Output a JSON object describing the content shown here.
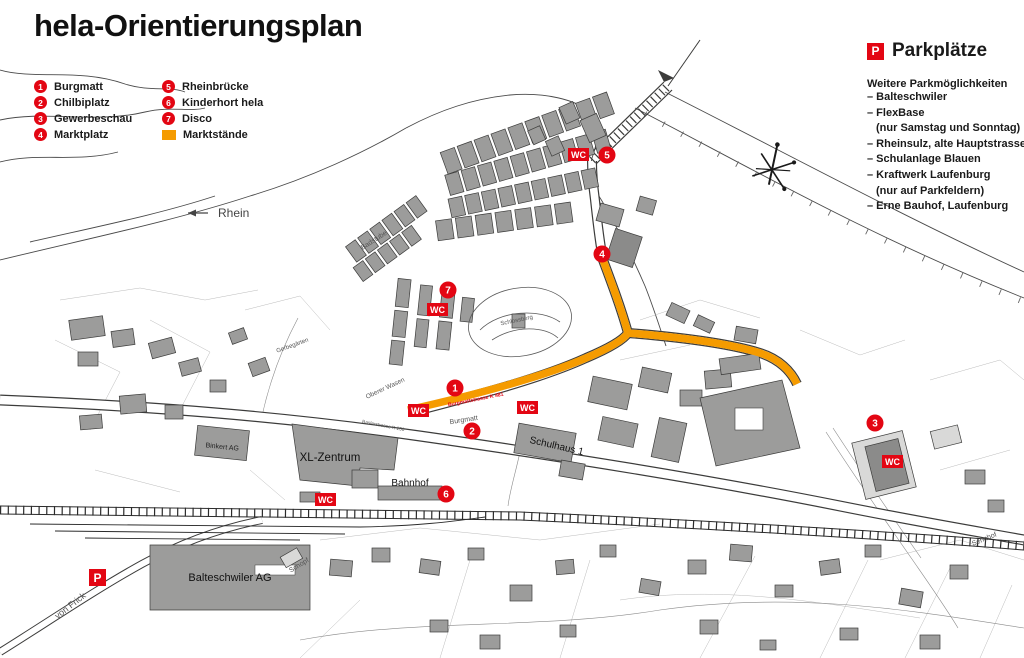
{
  "title": "hela-Orientierungsplan",
  "legend": {
    "items": [
      {
        "num": "1",
        "label": "Burgmatt"
      },
      {
        "num": "2",
        "label": "Chilbiplatz"
      },
      {
        "num": "3",
        "label": "Gewerbeschau"
      },
      {
        "num": "4",
        "label": "Marktplatz"
      },
      {
        "num": "5",
        "label": "Rheinbrücke"
      },
      {
        "num": "6",
        "label": "Kinderhort hela"
      },
      {
        "num": "7",
        "label": "Disco"
      }
    ],
    "swatch_label": "Marktstände"
  },
  "parking": {
    "badge": "P",
    "title": "Parkplätze",
    "subtitle": "Weitere Parkmöglichkeiten",
    "lines": [
      "– Balteschwiler",
      "– FlexBase",
      "(nur Samstag und Sonntag)",
      "– Rheinsulz, alte Hauptstrasse",
      "– Schulanlage Blauen",
      "– Kraftwerk Laufenburg",
      "(nur auf Parkfeldern)",
      "– Erne Bauhof, Laufenburg"
    ]
  },
  "map": {
    "wc_label": "WC",
    "p_label": "P",
    "labels": {
      "rhein": "Rhein",
      "badstube": "Badstube",
      "schlossberg": "Schlossberg",
      "gerbegaerten": "Gerbegärten",
      "oberer_wasen": "Oberer Wasen",
      "burgmatt": "Burgmatt",
      "burgmattstrasse": "Burgmattstrasse  K 481",
      "baslerstrasse": "Baslerstrasse  K 130",
      "xl_zentrum": "XL-Zentrum",
      "binkert": "Binkert AG",
      "bahnhof": "Bahnhof",
      "schulhaus": "Schulhaus 1",
      "balteschwiler": "Balteschwiler AG",
      "schopf": "Schopf",
      "von_frick": "von Frick",
      "sennhof": "Sennhof"
    },
    "colors": {
      "red": "#e30613",
      "orange": "#f59b00",
      "building_gray": "#9c9c9b"
    }
  }
}
